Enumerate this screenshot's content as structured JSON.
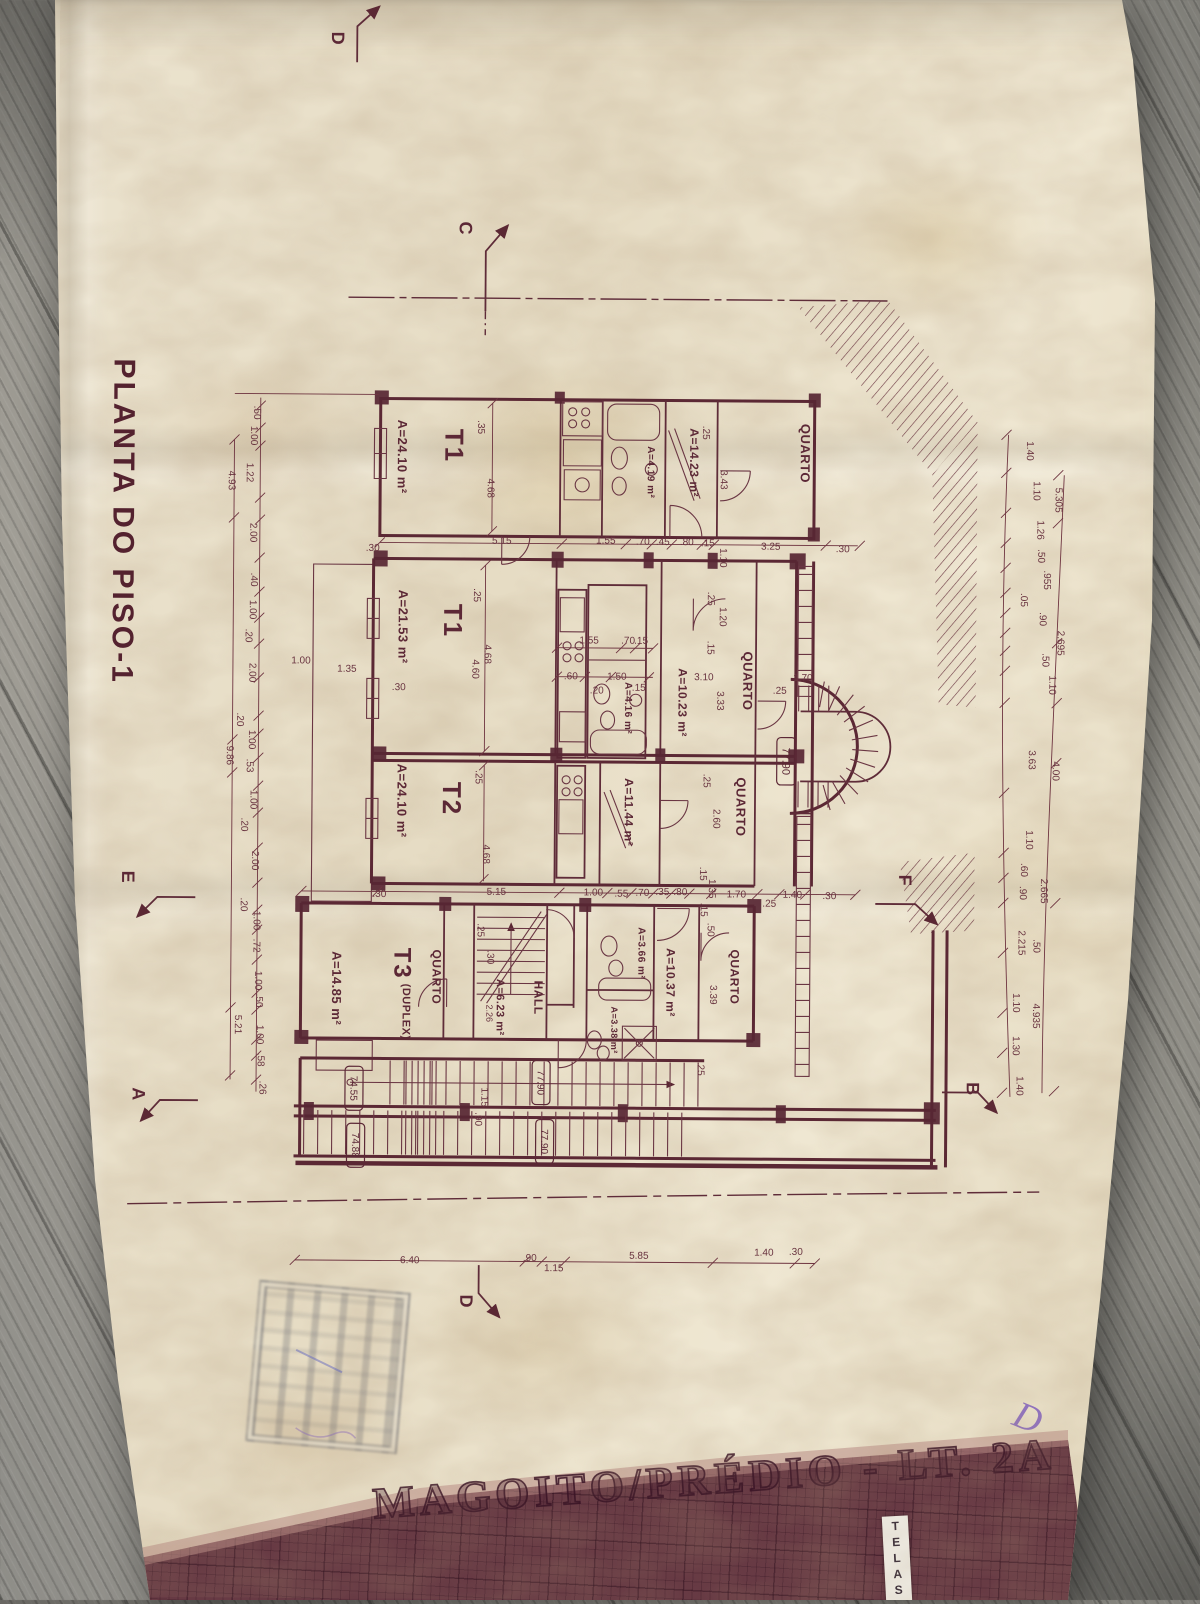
{
  "document": {
    "drawing_title": "PLANTA DO PISO-1",
    "project_title": "MAGOITO/PRÉDIO - LT. 2A",
    "sticker_label": "TELAS",
    "handwritten_mark": "D"
  },
  "colors": {
    "ink": "#5c2836",
    "paper": "#e9e0cb",
    "band": "#714049",
    "wood": "#8f8d86"
  },
  "plan": {
    "labels": [
      {
        "t": "PLANTA DO PISO-1",
        "x": 122,
        "y": 525,
        "r": 90,
        "s": 30,
        "c": "title"
      },
      {
        "t": "T1",
        "x": 452,
        "y": 447,
        "r": 90,
        "s": 26,
        "c": "room"
      },
      {
        "t": "A=24.10 m²",
        "x": 400,
        "y": 458,
        "r": 90,
        "s": 13,
        "c": "area"
      },
      {
        "t": "QUARTO",
        "x": 803,
        "y": 452,
        "r": 90,
        "s": 13,
        "c": "area"
      },
      {
        "t": "A=14.23 m²",
        "x": 692,
        "y": 462,
        "r": 90,
        "s": 12,
        "c": "area"
      },
      {
        "t": "A=4.19 m²",
        "x": 649,
        "y": 472,
        "r": 90,
        "s": 10,
        "c": "area"
      },
      {
        "t": "T1",
        "x": 452,
        "y": 622,
        "r": 90,
        "s": 26,
        "c": "room"
      },
      {
        "t": "A=21.53 m²",
        "x": 402,
        "y": 628,
        "r": 90,
        "s": 13,
        "c": "area"
      },
      {
        "t": "QUARTO",
        "x": 747,
        "y": 680,
        "r": 90,
        "s": 13,
        "c": "area"
      },
      {
        "t": "A=10.23 m²",
        "x": 682,
        "y": 702,
        "r": 90,
        "s": 12,
        "c": "area"
      },
      {
        "t": "A=4.16 m²",
        "x": 628,
        "y": 708,
        "r": 90,
        "s": 10,
        "c": "area"
      },
      {
        "t": "T2",
        "x": 452,
        "y": 800,
        "r": 90,
        "s": 26,
        "c": "room"
      },
      {
        "t": "A=24.10 m²",
        "x": 402,
        "y": 802,
        "r": 90,
        "s": 13,
        "c": "area"
      },
      {
        "t": "A=11.44 m²",
        "x": 629,
        "y": 812,
        "r": 90,
        "s": 12,
        "c": "area"
      },
      {
        "t": "QUARTO",
        "x": 741,
        "y": 806,
        "r": 90,
        "s": 13,
        "c": "area"
      },
      {
        "t": "T3",
        "x": 404,
        "y": 965,
        "r": 90,
        "s": 24,
        "c": "room"
      },
      {
        "t": "(DUPLEX)",
        "x": 408,
        "y": 1013,
        "r": 90,
        "s": 11,
        "c": "area"
      },
      {
        "t": "A=14.85 m²",
        "x": 338,
        "y": 990,
        "r": 90,
        "s": 13,
        "c": "area"
      },
      {
        "t": "QUARTO",
        "x": 438,
        "y": 978,
        "r": 90,
        "s": 12,
        "c": "area"
      },
      {
        "t": "A=6.23 m²",
        "x": 502,
        "y": 1008,
        "r": 90,
        "s": 11,
        "c": "area"
      },
      {
        "t": "2.26",
        "x": 491,
        "y": 1014,
        "r": 90,
        "s": 9,
        "c": "dim"
      },
      {
        "t": "HALL",
        "x": 540,
        "y": 998,
        "r": 90,
        "s": 12,
        "c": "area"
      },
      {
        "t": "A=3.66 m²",
        "x": 643,
        "y": 953,
        "r": 90,
        "s": 10,
        "c": "area"
      },
      {
        "t": "A=10.37 m²",
        "x": 672,
        "y": 982,
        "r": 90,
        "s": 12,
        "c": "area"
      },
      {
        "t": "QUARTO",
        "x": 736,
        "y": 976,
        "r": 90,
        "s": 12,
        "c": "area"
      },
      {
        "t": "3.39",
        "x": 715,
        "y": 994,
        "r": 90,
        "s": 10,
        "c": "dim"
      },
      {
        "t": "A=3.38 m²",
        "x": 616,
        "y": 1030,
        "r": 90,
        "s": 9,
        "c": "area"
      },
      {
        "t": "77.90",
        "x": 786,
        "y": 760,
        "r": 90,
        "s": 11,
        "c": "level",
        "box": true
      },
      {
        "t": "74.55",
        "x": 356,
        "y": 1090,
        "r": 90,
        "s": 10,
        "c": "level",
        "box": true
      },
      {
        "t": "74.88",
        "x": 358,
        "y": 1147,
        "r": 90,
        "s": 10,
        "c": "level",
        "box": true
      },
      {
        "t": "77.90",
        "x": 543,
        "y": 1083,
        "r": 90,
        "s": 10,
        "c": "level",
        "box": true
      },
      {
        "t": "77.90",
        "x": 547,
        "y": 1142,
        "r": 90,
        "s": 10,
        "c": "level",
        "box": true
      },
      {
        "t": "D",
        "x": 333,
        "y": 40,
        "r": 90,
        "s": 18,
        "c": "section"
      },
      {
        "t": "C",
        "x": 462,
        "y": 229,
        "r": 90,
        "s": 18,
        "c": "section"
      },
      {
        "t": "E",
        "x": 129,
        "y": 880,
        "r": 90,
        "s": 18,
        "c": "section"
      },
      {
        "t": "F",
        "x": 906,
        "y": 878,
        "r": 90,
        "s": 18,
        "c": "section"
      },
      {
        "t": "A",
        "x": 141,
        "y": 1097,
        "r": 90,
        "s": 18,
        "c": "section"
      },
      {
        "t": "B",
        "x": 975,
        "y": 1086,
        "r": 90,
        "s": 18,
        "c": "section"
      },
      {
        "t": "D",
        "x": 470,
        "y": 1302,
        "r": 90,
        "s": 18,
        "c": "section"
      },
      {
        "t": ".30",
        "x": 371,
        "y": 549,
        "c": "dim"
      },
      {
        "t": "5.15",
        "x": 500,
        "y": 541,
        "c": "dim"
      },
      {
        "t": "1.55",
        "x": 604,
        "y": 540,
        "c": "dim"
      },
      {
        "t": ".70",
        "x": 641,
        "y": 541,
        "c": "dim"
      },
      {
        "t": ".45",
        "x": 661,
        "y": 541,
        "c": "dim"
      },
      {
        "t": ".80",
        "x": 685,
        "y": 541,
        "c": "dim"
      },
      {
        "t": ".15",
        "x": 706,
        "y": 542,
        "c": "dim"
      },
      {
        "t": "3.25",
        "x": 769,
        "y": 545,
        "c": "dim"
      },
      {
        "t": ".30",
        "x": 841,
        "y": 547,
        "c": "dim"
      },
      {
        "t": ".30",
        "x": 380,
        "y": 895,
        "c": "dim"
      },
      {
        "t": "5.15",
        "x": 497,
        "y": 892,
        "c": "dim"
      },
      {
        "t": "1.00",
        "x": 594,
        "y": 892,
        "c": "dim"
      },
      {
        "t": ".55",
        "x": 622,
        "y": 893,
        "c": "dim"
      },
      {
        "t": ".70",
        "x": 643,
        "y": 892,
        "c": "dim"
      },
      {
        "t": ".35",
        "x": 663,
        "y": 891,
        "c": "dim"
      },
      {
        "t": ".80",
        "x": 681,
        "y": 891,
        "c": "dim"
      },
      {
        "t": "1.70",
        "x": 737,
        "y": 893,
        "c": "dim"
      },
      {
        "t": ".25",
        "x": 770,
        "y": 902,
        "c": "dim"
      },
      {
        "t": "1.40",
        "x": 793,
        "y": 893,
        "c": "dim"
      },
      {
        "t": ".30",
        "x": 830,
        "y": 894,
        "c": "dim"
      },
      {
        "t": "1.55",
        "x": 588,
        "y": 640,
        "c": "dim"
      },
      {
        "t": ".70",
        "x": 627,
        "y": 640,
        "c": "dim"
      },
      {
        "t": ".15",
        "x": 640,
        "y": 640,
        "c": "dim"
      },
      {
        "t": ".60",
        "x": 570,
        "y": 676,
        "c": "dim"
      },
      {
        "t": "1.50",
        "x": 616,
        "y": 676,
        "c": "dim"
      },
      {
        "t": ".15",
        "x": 638,
        "y": 687,
        "c": "dim"
      },
      {
        "t": ".20",
        "x": 596,
        "y": 690,
        "c": "dim"
      },
      {
        "t": "3.10",
        "x": 703,
        "y": 676,
        "c": "dim"
      },
      {
        "t": "1.70",
        "x": 802,
        "y": 676,
        "c": "dim"
      },
      {
        "t": ".25",
        "x": 779,
        "y": 689,
        "c": "dim"
      },
      {
        "t": "1.00",
        "x": 300,
        "y": 662,
        "c": "dim"
      },
      {
        "t": "1.35",
        "x": 346,
        "y": 670,
        "c": "dim"
      },
      {
        "t": ".30",
        "x": 398,
        "y": 688,
        "c": "dim"
      },
      {
        "t": "6.40",
        "x": 413,
        "y": 1261,
        "c": "dim"
      },
      {
        "t": ".90",
        "x": 533,
        "y": 1258,
        "c": "dim"
      },
      {
        "t": "1.15",
        "x": 557,
        "y": 1268,
        "c": "dim"
      },
      {
        "t": "5.85",
        "x": 642,
        "y": 1255,
        "c": "dim"
      },
      {
        "t": "1.40",
        "x": 767,
        "y": 1251,
        "c": "dim"
      },
      {
        "t": ".30",
        "x": 799,
        "y": 1250,
        "c": "dim"
      },
      {
        "t": "4.68",
        "x": 489,
        "y": 489,
        "r": 90,
        "c": "dim"
      },
      {
        "t": ".35",
        "x": 479,
        "y": 428,
        "r": 90,
        "c": "dim"
      },
      {
        "t": "3.43",
        "x": 722,
        "y": 479,
        "r": 90,
        "c": "dim"
      },
      {
        "t": ".25",
        "x": 704,
        "y": 432,
        "r": 90,
        "c": "dim"
      },
      {
        "t": "1.10",
        "x": 722,
        "y": 557,
        "r": 90,
        "c": "dim"
      },
      {
        "t": "4.68",
        "x": 487,
        "y": 655,
        "r": 90,
        "c": "dim"
      },
      {
        "t": "4.60",
        "x": 475,
        "y": 670,
        "r": 90,
        "c": "dim"
      },
      {
        "t": ".25",
        "x": 476,
        "y": 596,
        "r": 90,
        "c": "dim"
      },
      {
        "t": "1.20",
        "x": 722,
        "y": 616,
        "r": 90,
        "c": "dim"
      },
      {
        "t": ".15",
        "x": 710,
        "y": 647,
        "r": 90,
        "c": "dim"
      },
      {
        "t": ".25",
        "x": 710,
        "y": 598,
        "r": 90,
        "c": "dim"
      },
      {
        "t": "3.33",
        "x": 720,
        "y": 700,
        "r": 90,
        "c": "dim"
      },
      {
        "t": "4.68",
        "x": 487,
        "y": 855,
        "r": 90,
        "c": "dim"
      },
      {
        "t": ".25",
        "x": 479,
        "y": 778,
        "r": 90,
        "c": "dim"
      },
      {
        "t": "2.60",
        "x": 717,
        "y": 818,
        "r": 90,
        "c": "dim"
      },
      {
        "t": ".25",
        "x": 707,
        "y": 780,
        "r": 90,
        "c": "dim"
      },
      {
        "t": ".15",
        "x": 704,
        "y": 873,
        "r": 90,
        "c": "dim"
      },
      {
        "t": "1.35",
        "x": 713,
        "y": 888,
        "r": 90,
        "c": "dim"
      },
      {
        "t": ".25",
        "x": 482,
        "y": 931,
        "r": 90,
        "c": "dim"
      },
      {
        "t": ".30",
        "x": 492,
        "y": 958,
        "r": 90,
        "c": "dim"
      },
      {
        "t": ".15",
        "x": 705,
        "y": 909,
        "r": 90,
        "c": "dim"
      },
      {
        "t": ".50",
        "x": 712,
        "y": 929,
        "r": 90,
        "c": "dim"
      },
      {
        "t": ".25",
        "x": 703,
        "y": 1068,
        "r": 90,
        "c": "dim"
      },
      {
        "t": "1.15",
        "x": 487,
        "y": 1098,
        "r": 90,
        "c": "dim"
      },
      {
        "t": ".90",
        "x": 481,
        "y": 1120,
        "r": 90,
        "c": "dim"
      },
      {
        "t": ".50",
        "x": 255,
        "y": 415,
        "r": 90,
        "c": "dim"
      },
      {
        "t": "1.00",
        "x": 252,
        "y": 438,
        "r": 90,
        "c": "dim"
      },
      {
        "t": "1.22",
        "x": 248,
        "y": 475,
        "r": 90,
        "c": "dim"
      },
      {
        "t": "4.93",
        "x": 230,
        "y": 483,
        "r": 90,
        "c": "dim"
      },
      {
        "t": "2.00",
        "x": 252,
        "y": 535,
        "r": 90,
        "c": "dim"
      },
      {
        "t": ".40",
        "x": 253,
        "y": 582,
        "r": 90,
        "c": "dim"
      },
      {
        "t": "1.00",
        "x": 252,
        "y": 612,
        "r": 90,
        "c": "dim"
      },
      {
        "t": ".20",
        "x": 248,
        "y": 638,
        "r": 90,
        "c": "dim"
      },
      {
        "t": "2.00",
        "x": 252,
        "y": 675,
        "r": 90,
        "c": "dim"
      },
      {
        "t": ".20",
        "x": 240,
        "y": 722,
        "r": 90,
        "c": "dim"
      },
      {
        "t": "1.00",
        "x": 252,
        "y": 742,
        "r": 90,
        "c": "dim"
      },
      {
        "t": "9.86",
        "x": 230,
        "y": 758,
        "r": 90,
        "c": "dim"
      },
      {
        "t": ".53",
        "x": 250,
        "y": 768,
        "r": 90,
        "c": "dim"
      },
      {
        "t": "1.00",
        "x": 254,
        "y": 802,
        "r": 90,
        "c": "dim"
      },
      {
        "t": ".20",
        "x": 245,
        "y": 827,
        "r": 90,
        "c": "dim"
      },
      {
        "t": "2.00",
        "x": 256,
        "y": 863,
        "r": 90,
        "c": "dim"
      },
      {
        "t": ".20",
        "x": 245,
        "y": 907,
        "r": 90,
        "c": "dim"
      },
      {
        "t": "1.00",
        "x": 258,
        "y": 923,
        "r": 90,
        "c": "dim"
      },
      {
        "t": ".72",
        "x": 258,
        "y": 948,
        "r": 90,
        "c": "dim"
      },
      {
        "t": "1.00",
        "x": 260,
        "y": 983,
        "r": 90,
        "c": "dim"
      },
      {
        "t": ".50",
        "x": 261,
        "y": 1003,
        "r": 90,
        "c": "dim"
      },
      {
        "t": "5.21",
        "x": 240,
        "y": 1027,
        "r": 90,
        "c": "dim"
      },
      {
        "t": "1.00",
        "x": 262,
        "y": 1037,
        "r": 90,
        "c": "dim"
      },
      {
        "t": ".58",
        "x": 263,
        "y": 1062,
        "r": 90,
        "c": "dim"
      },
      {
        "t": ".26",
        "x": 265,
        "y": 1090,
        "r": 90,
        "c": "dim"
      },
      {
        "t": "1.40",
        "x": 1028,
        "y": 448,
        "r": 90,
        "c": "dim"
      },
      {
        "t": "1.10",
        "x": 1035,
        "y": 488,
        "r": 90,
        "c": "dim"
      },
      {
        "t": "5.305",
        "x": 1057,
        "y": 497,
        "r": 90,
        "c": "dim"
      },
      {
        "t": "1.26",
        "x": 1039,
        "y": 527,
        "r": 90,
        "c": "dim"
      },
      {
        "t": ".50",
        "x": 1040,
        "y": 553,
        "r": 90,
        "c": "dim"
      },
      {
        "t": ".955",
        "x": 1046,
        "y": 577,
        "r": 90,
        "c": "dim"
      },
      {
        "t": ".05",
        "x": 1023,
        "y": 597,
        "r": 90,
        "c": "dim"
      },
      {
        "t": ".90",
        "x": 1042,
        "y": 616,
        "r": 90,
        "c": "dim"
      },
      {
        "t": "2.695",
        "x": 1060,
        "y": 640,
        "r": 90,
        "c": "dim"
      },
      {
        "t": ".50",
        "x": 1045,
        "y": 657,
        "r": 90,
        "c": "dim"
      },
      {
        "t": "1.10",
        "x": 1052,
        "y": 682,
        "r": 90,
        "c": "dim"
      },
      {
        "t": "3.63",
        "x": 1032,
        "y": 757,
        "r": 90,
        "c": "dim"
      },
      {
        "t": "4.00",
        "x": 1056,
        "y": 768,
        "r": 90,
        "c": "dim"
      },
      {
        "t": "1.10",
        "x": 1030,
        "y": 837,
        "r": 90,
        "c": "dim"
      },
      {
        "t": ".60",
        "x": 1025,
        "y": 867,
        "r": 90,
        "c": "dim"
      },
      {
        "t": ".90",
        "x": 1024,
        "y": 890,
        "r": 90,
        "c": "dim"
      },
      {
        "t": "2.665",
        "x": 1045,
        "y": 888,
        "r": 90,
        "c": "dim"
      },
      {
        "t": "2.215",
        "x": 1023,
        "y": 940,
        "r": 90,
        "c": "dim"
      },
      {
        "t": ".50",
        "x": 1038,
        "y": 943,
        "r": 90,
        "c": "dim"
      },
      {
        "t": "1.10",
        "x": 1018,
        "y": 1000,
        "r": 90,
        "c": "dim"
      },
      {
        "t": "4.935",
        "x": 1038,
        "y": 1013,
        "r": 90,
        "c": "dim"
      },
      {
        "t": "1.30",
        "x": 1018,
        "y": 1043,
        "r": 90,
        "c": "dim"
      },
      {
        "t": "1.40",
        "x": 1022,
        "y": 1083,
        "r": 90,
        "c": "dim"
      }
    ]
  }
}
